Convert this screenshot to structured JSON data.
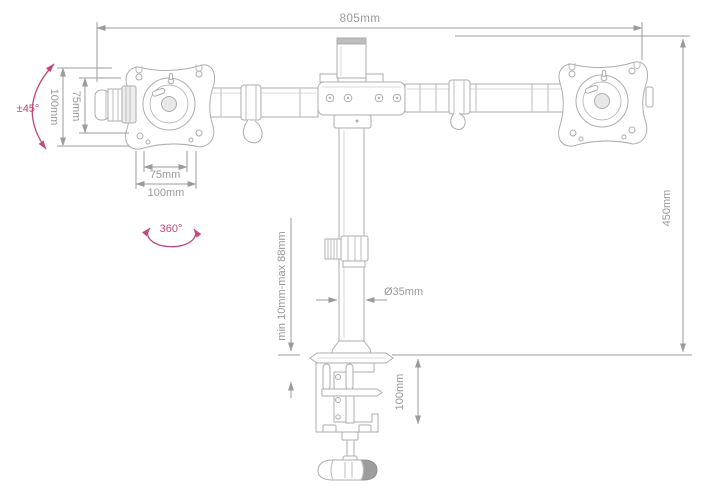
{
  "diagram": {
    "product_name": "dual-monitor-desk-mount-arm",
    "colors": {
      "part_line": "#adadad",
      "dimension_line": "#9b9b9b",
      "label_text": "#999999",
      "accent_pink": "#c2497d"
    },
    "dimensions": {
      "overall_width": "805mm",
      "pole_height": "450mm",
      "plate_height_outer": "100mm",
      "plate_height_inner": "75mm",
      "plate_width_inner": "75mm",
      "plate_width_outer": "100mm",
      "tilt_range": "±45°",
      "swivel_range": "360°",
      "pole_diameter": "Ø35mm",
      "clamp_opening": "min 10mm-max 88mm",
      "clamp_bracket_height": "100mm"
    }
  }
}
